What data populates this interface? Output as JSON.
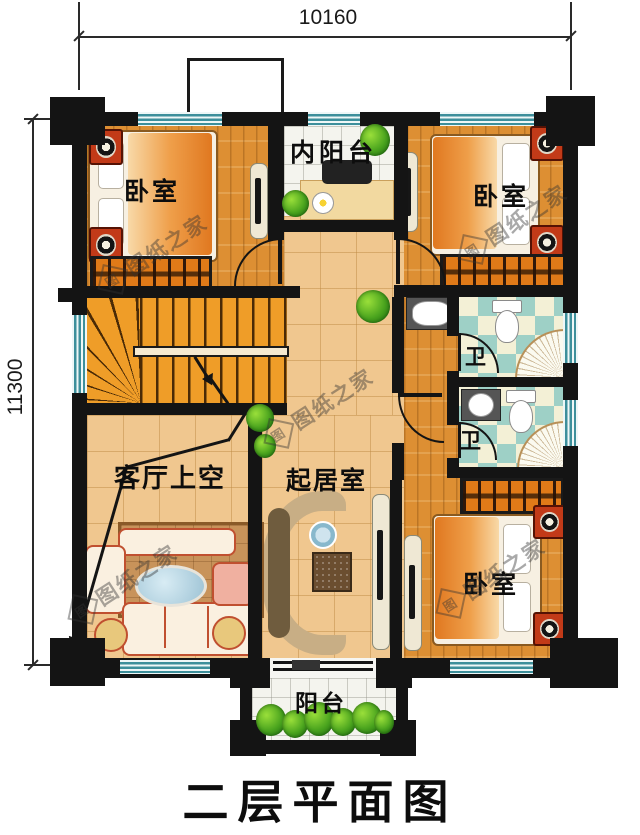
{
  "dimensions": {
    "top": "10160",
    "left": "11300"
  },
  "title": "二层平面图",
  "rooms": {
    "bedroom_top_left": {
      "label": "卧室"
    },
    "bedroom_top_right": {
      "label": "卧室"
    },
    "bedroom_bottom_right": {
      "label": "卧室"
    },
    "inner_balcony": {
      "label": "内阳台"
    },
    "living_room_void": {
      "label": "客厅上空"
    },
    "sitting_room": {
      "label": "起居室"
    },
    "bathroom_upper": {
      "label": "卫"
    },
    "bathroom_lower": {
      "label": "卫"
    },
    "balcony": {
      "label": "阳台"
    }
  },
  "watermark": {
    "text": "图纸之家",
    "seal_char": "图"
  },
  "colors": {
    "wall": "#141414",
    "wood": "#dd8f33",
    "tile_tan": "#f0c78f",
    "tile_white": "#f4f4ee",
    "bath_teal": "#9ed0c6",
    "bath_cream": "#f3f0d6",
    "stairs": "#ef9d28",
    "window": "#3d8f9b"
  }
}
